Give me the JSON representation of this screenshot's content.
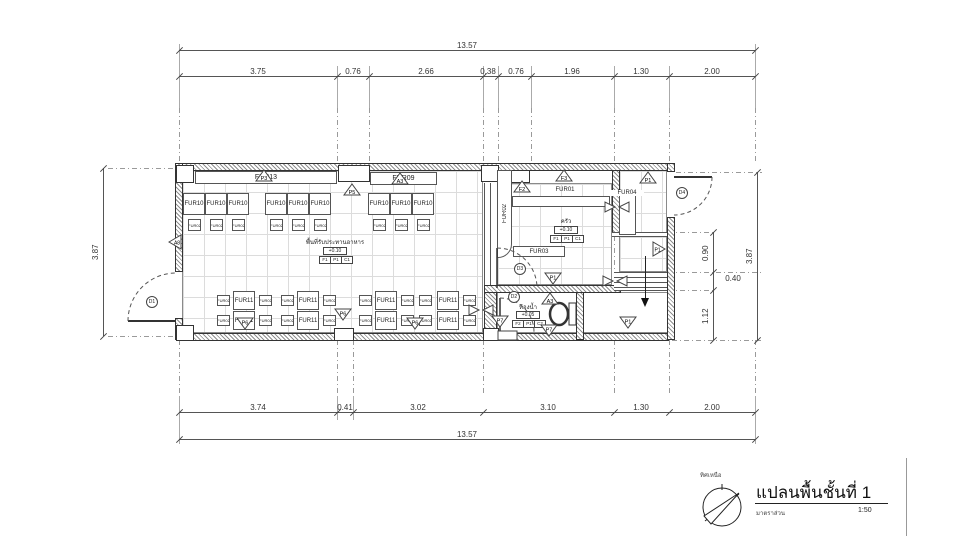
{
  "sheet": {
    "title": "แปลนพื้นชั้นที่ 1",
    "scale_label": "มาตราส่วน",
    "scale_value": "1:50",
    "north_label": "ทิศเหนือ"
  },
  "dims": {
    "top_total": "13.57",
    "top_segments": [
      "3.75",
      "0.76",
      "2.66",
      "0.38",
      "0.76",
      "1.96",
      "1.30",
      "2.00"
    ],
    "bottom_segments": [
      "3.74",
      "0.41",
      "3.02",
      "3.10",
      "1.30",
      "2.00"
    ],
    "bottom_total": "13.57",
    "left_total": "3.87",
    "right_segments": [
      "0.90",
      "0.40",
      "1.12"
    ],
    "right_total": "3.87"
  },
  "labels": {
    "fur01": "FUR01",
    "fur02": "FUR02",
    "fur03": "FUR03",
    "fur04": "FUR04",
    "fur09": "FUR09",
    "fur10": "FUR10",
    "fur11": "FUR11",
    "fur13": "FUR13"
  },
  "rooms": {
    "dining": {
      "name": "พื้นที่รับประทานอาหาร",
      "level": "+0.10",
      "finish": [
        "F1",
        "P1",
        "C1"
      ]
    },
    "kitchen": {
      "name": "ครัว",
      "level": "+0.10",
      "finish": [
        "F1",
        "P1",
        "C1"
      ]
    },
    "bathroom": {
      "name": "ห้องน้ำ",
      "level": "+0.05",
      "finish": [
        "F2",
        "P1",
        "C2"
      ]
    }
  },
  "doors": {
    "d1": "D1",
    "d2": "D2",
    "d3": "D3",
    "d4": "D4"
  },
  "markers": [
    {
      "label": "P3"
    },
    {
      "label": "P5"
    },
    {
      "label": "A3"
    },
    {
      "label": "A8"
    },
    {
      "label": "F2"
    },
    {
      "label": "F3"
    },
    {
      "label": "P1"
    },
    {
      "label": "P1"
    },
    {
      "label": "P1"
    },
    {
      "label": "P6"
    },
    {
      "label": "P6"
    },
    {
      "label": "P6"
    },
    {
      "label": "A3"
    },
    {
      "label": "P7"
    },
    {
      "label": "P7"
    },
    {
      "label": "P1"
    }
  ]
}
